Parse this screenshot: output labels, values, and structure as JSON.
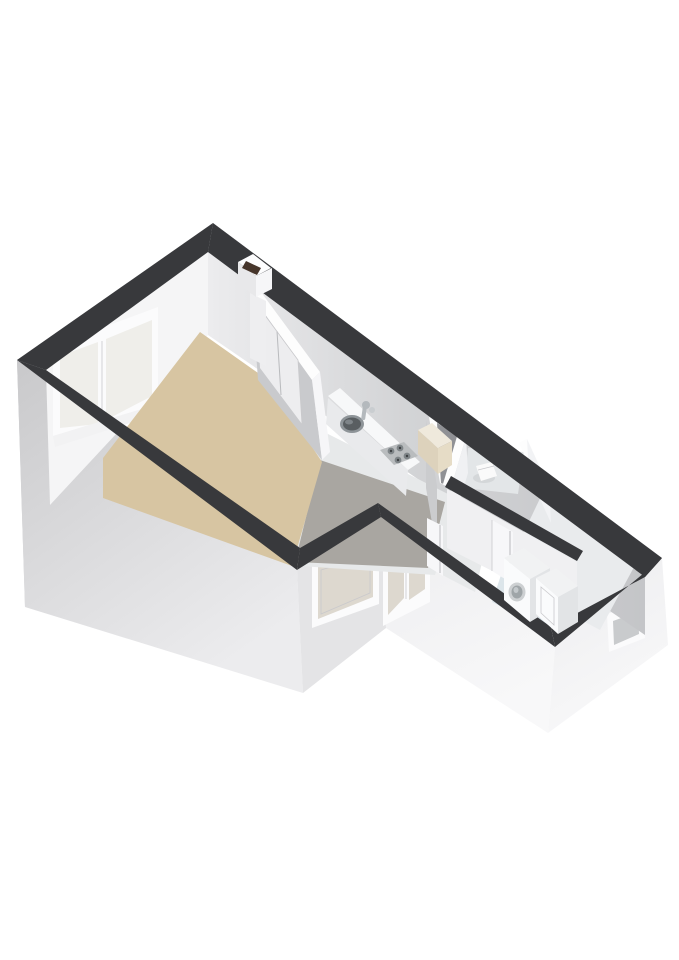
{
  "scene": {
    "type": "3d-floorplan-render",
    "background": "#ffffff",
    "description": "Isometric 3D floor plan of a small apartment viewed from above-left; no text labels rendered",
    "colors": {
      "wall_top": "#38393c",
      "interior_wall_top": "#fdfdfd",
      "facade_left": "#c6c6c8",
      "facade_front": "#d6d6d8",
      "facade_front_light": "#ebebed",
      "facade_right": "#f3f3f5",
      "wall_interior_bright": "#f5f5f6",
      "wall_interior_mid": "#dcdcde",
      "wall_interior_shaded": "#cbccce",
      "partition_face": "#c9cacd",
      "living_floor": "#d7c5a2",
      "kitchen_floor": "#a9a6a1",
      "hall_floor": "#e7e9ea",
      "bath_floor": "#e3e6e8",
      "laundry_floor": "#e9ebed",
      "mat_floor": "#dce5ea",
      "glass_warm": "#ddd8cf",
      "glass_pane": "#efeeea",
      "glass_cool": "#c9cbcd",
      "window_frame": "#fbfbfc",
      "door_leaf": "#f7f7f9",
      "counter_top": "#f7f8f9",
      "counter_front": "#e9eaec",
      "stove_panel": "#b9bcbe",
      "burner": "#7e8487",
      "sink_rim": "#8e9498",
      "sink_basin": "#595e61",
      "faucet": "#b4b9bd",
      "fridge_front": "#ddd2bc",
      "fridge_top": "#efe9dc",
      "flue_dark": "#46352b",
      "appliance_top": "#f1f2f3",
      "appliance_front": "#fafbfc",
      "appliance_side": "#e2e4e6",
      "shaft": "#909195"
    },
    "rooms": [
      {
        "id": "living-room",
        "floor": "beige"
      },
      {
        "id": "kitchen",
        "floor": "grey-tile"
      },
      {
        "id": "hallway",
        "floor": "light-grey"
      },
      {
        "id": "toilet",
        "floor": "light-grey"
      },
      {
        "id": "laundry-room",
        "floor": "light-grey"
      }
    ],
    "fixtures": [
      {
        "id": "kitchen-counter"
      },
      {
        "id": "sink"
      },
      {
        "id": "gas-stove",
        "burners": 4
      },
      {
        "id": "refrigerator"
      },
      {
        "id": "chimney-flue"
      },
      {
        "id": "toilet-bowl"
      },
      {
        "id": "washing-machine"
      },
      {
        "id": "dryer-boiler"
      }
    ],
    "windows": [
      {
        "id": "living-end-window",
        "panes": 2
      },
      {
        "id": "living-front-window",
        "panes": 1
      },
      {
        "id": "balcony-glass-door",
        "panes": 2
      },
      {
        "id": "laundry-small-window",
        "panes": 1
      }
    ],
    "doors": [
      {
        "id": "living-kitchen-double-door"
      },
      {
        "id": "kitchen-hall-door"
      },
      {
        "id": "toilet-door"
      }
    ]
  }
}
